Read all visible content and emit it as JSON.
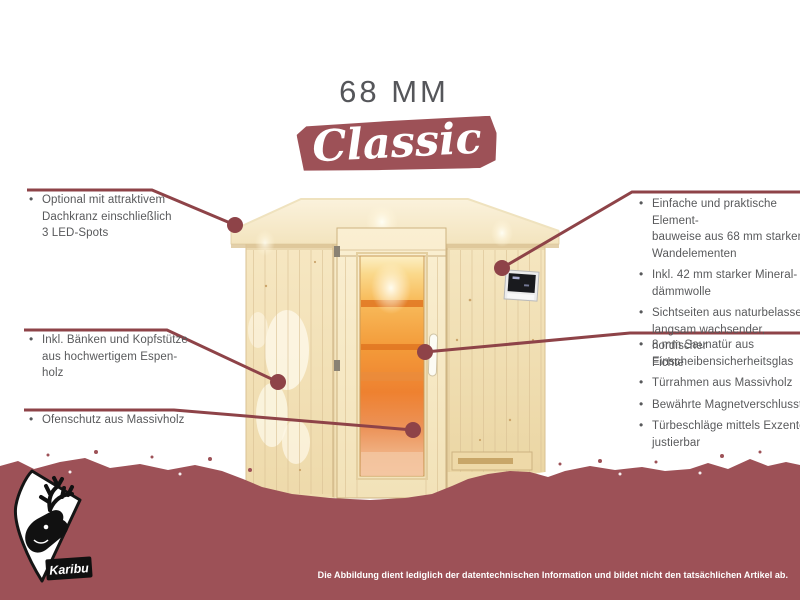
{
  "colors": {
    "maroon": "#9D5157",
    "maroon-dark": "#8E4348",
    "text-gray": "#58595B",
    "title-gray": "#55565A",
    "wood-light": "#F8ECCB",
    "wood-dark": "#EFDCAE",
    "glass-orange": "#F39A39"
  },
  "glyphs": {
    "bullet": "•"
  },
  "header": {
    "title": "68 MM",
    "badge": "Classic"
  },
  "features_left": [
    {
      "text": "Optional mit attraktivem\nDachkranz einschließlich\n3 LED-Spots"
    },
    {
      "text": "Inkl. Bänken und Kopfstütze\naus hochwertigem Espen-\nholz"
    },
    {
      "text": "Ofenschutz aus Massivholz"
    }
  ],
  "features_right_top": [
    {
      "text": "Einfache und praktische Element-\nbauweise aus 68 mm starken\nWandelementen"
    },
    {
      "text": "Inkl. 42 mm starker Mineral-\ndämmwolle"
    },
    {
      "text": "Sichtseiten aus naturbelassener,\nlangsam wachsender, nordischer\nFichte"
    }
  ],
  "features_right_bottom": [
    {
      "text": "8 mm Saunatür aus\nEinscheibensicherheitsglas"
    },
    {
      "text": "Türrahmen aus Massivholz"
    },
    {
      "text": "Bewährte Magnetverschlusstechnik"
    },
    {
      "text": "Türbeschläge mittels Exzenter\njustierbar"
    }
  ],
  "logo": {
    "label": "Karibu"
  },
  "footer": {
    "disclaimer": "Die Abbildung dient lediglich der datentechnischen Information und bildet nicht den tatsächlichen Artikel ab."
  }
}
